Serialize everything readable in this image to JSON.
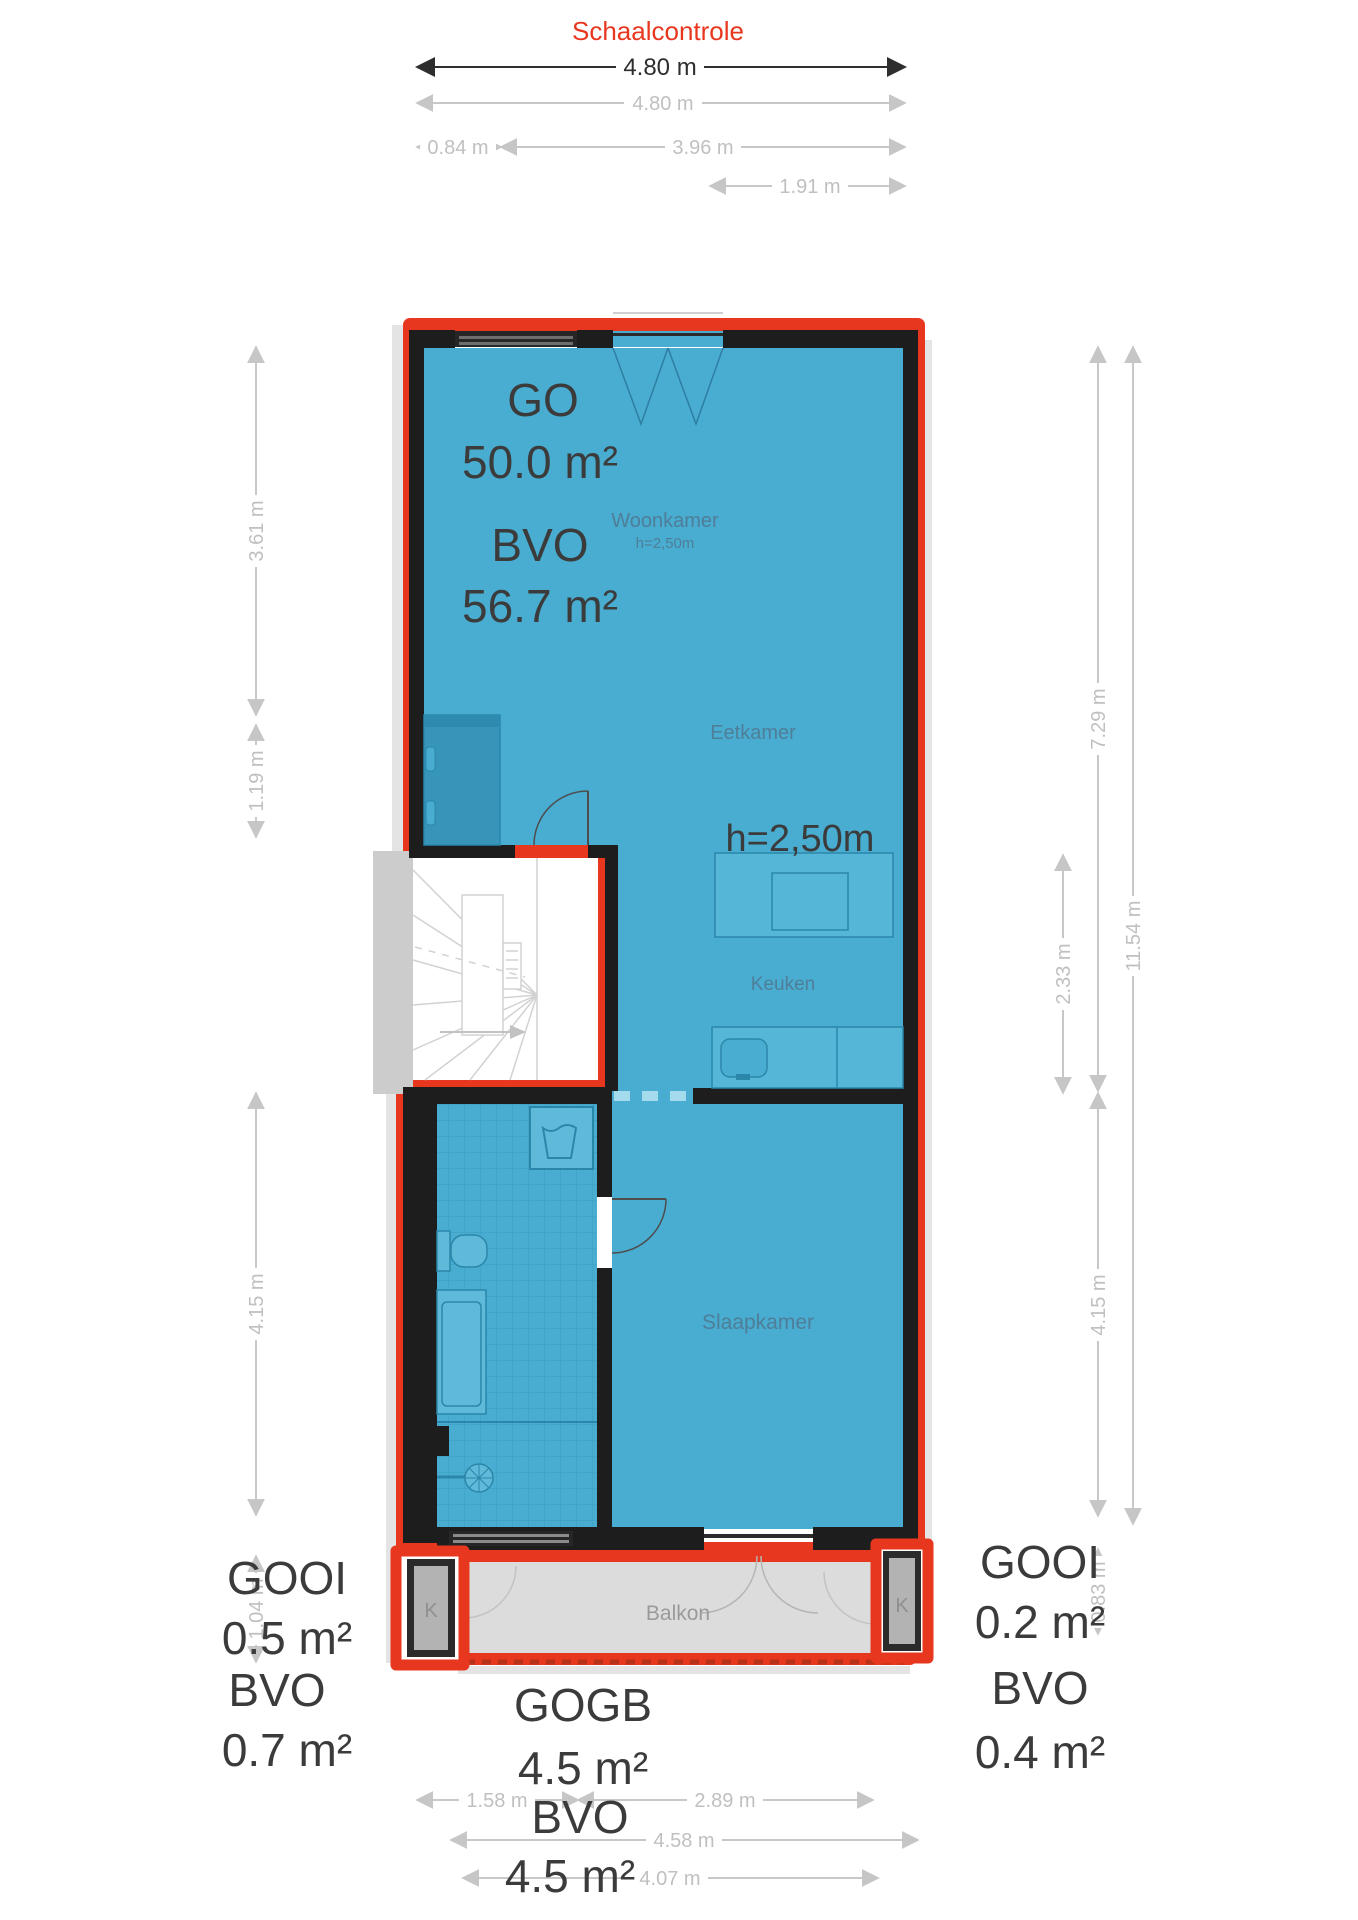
{
  "header": {
    "schaalcontrole": "Schaalcontrole"
  },
  "colors": {
    "outline_red": "#e8371f",
    "floor_blue": "#49acd1",
    "wall_black": "#1d1d1d",
    "dim_gray": "#c6c6c6",
    "dim_dark": "#2e2e2e"
  },
  "dimensions": {
    "top": [
      "4.80 m",
      "4.80 m",
      "0.84 m",
      "3.96 m",
      "1.91 m"
    ],
    "left": [
      "3.61 m",
      "1.19 m",
      "4.15 m",
      "1.04 m"
    ],
    "right": [
      "7.29 m",
      "2.33 m",
      "11.54 m",
      "4.15 m",
      "0.83 m"
    ],
    "bottom": [
      "1.58 m",
      "2.89 m",
      "4.58 m",
      "4.07 m"
    ]
  },
  "areas": {
    "main": {
      "go_label": "GO",
      "go_value": "50.0 m²",
      "bvo_label": "BVO",
      "bvo_value": "56.7 m²",
      "ceiling_height": "h=2,50m"
    },
    "left_closet": {
      "gooi_label": "GOOI",
      "gooi_value": "0.5 m²",
      "bvo_label": "BVO",
      "bvo_value": "0.7 m²"
    },
    "right_closet": {
      "gooi_label": "GOOI",
      "gooi_value": "0.2 m²",
      "bvo_label": "BVO",
      "bvo_value": "0.4 m²"
    },
    "balcony": {
      "gogb_label": "GOGB",
      "gogb_value": "4.5 m²",
      "bvo_label": "BVO",
      "bvo_value": "4.5 m²"
    }
  },
  "rooms": {
    "woonkamer": "Woonkamer",
    "woonkamer_height": "h=2,50m",
    "eetkamer": "Eetkamer",
    "keuken": "Keuken",
    "slaapkamer": "Slaapkamer",
    "balkon": "Balkon",
    "closet_left": "K",
    "closet_right": "K"
  }
}
